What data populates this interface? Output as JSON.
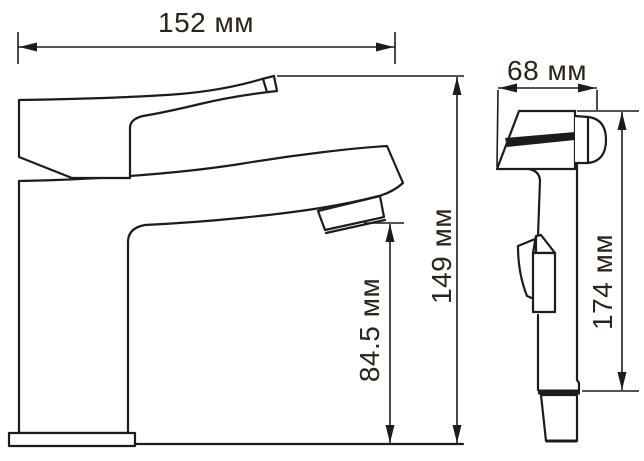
{
  "colors": {
    "background": "#ffffff",
    "line": "#1c1c1c",
    "text": "#2b241b"
  },
  "unit": "мм",
  "dimensions": {
    "side_width": "152 мм",
    "side_total_height": "149 мм",
    "side_spout_height": "84.5 мм",
    "front_width": "68 мм",
    "front_height": "174 мм"
  }
}
